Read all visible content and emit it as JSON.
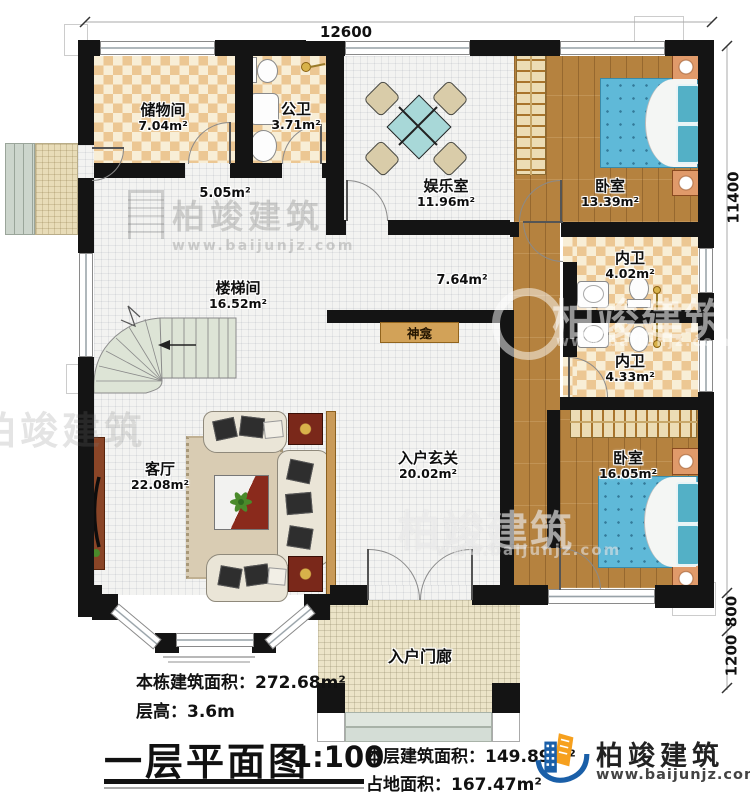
{
  "plan": {
    "rooms": {
      "storage": {
        "name": "储物间",
        "area": "7.04m²"
      },
      "public_bath": {
        "name": "公卫",
        "area": "3.71m²"
      },
      "entertainment": {
        "name": "娱乐室",
        "area": "11.96m²"
      },
      "bedroom_top": {
        "name": "卧室",
        "area": "13.39m²"
      },
      "ensuite_top": {
        "name": "内卫",
        "area": "4.02m²"
      },
      "ensuite_bottom": {
        "name": "内卫",
        "area": "4.33m²"
      },
      "stairwell": {
        "name": "楼梯间",
        "area": "16.52m²"
      },
      "living_room": {
        "name": "客厅",
        "area": "22.08m²"
      },
      "entry_foyer": {
        "name": "入户玄关",
        "area": "20.02m²"
      },
      "bedroom_bottom": {
        "name": "卧室",
        "area": "16.05m²"
      },
      "entry_porch": {
        "name": "入户门廊"
      },
      "shrine": {
        "name": "神龛"
      },
      "hallway_small_area": "5.05m²",
      "hallway_mid_area": "7.64m²"
    },
    "dimensions": {
      "top": "12600",
      "right_total": "11400",
      "right_mid": "800",
      "right_bottom": "1200"
    }
  },
  "title_block": {
    "building_total_area": "本栋建筑面积：272.68m²",
    "floor_height": "层高：3.6m",
    "plan_title": "一层平面图",
    "scale": "1:100",
    "floor_area": "本层建筑面积：149.89m²",
    "footprint_area": "占地面积：167.47m²"
  },
  "brand": {
    "name": "柏竣建筑",
    "url": "www.baijunjz.com"
  },
  "watermark": {
    "text": "柏竣建筑",
    "url": "www.baijunjz.com"
  },
  "colors": {
    "wall": "#141414",
    "checker_dark": "#ecc793",
    "checker_light": "#f8eed6",
    "wood": "#b5823f",
    "bed": "#5fb9d8",
    "stairs": "#dde4d6",
    "shrine": "#d2a258",
    "brand_blue": "#1a5fa8",
    "brand_orange": "#f6a01e"
  }
}
